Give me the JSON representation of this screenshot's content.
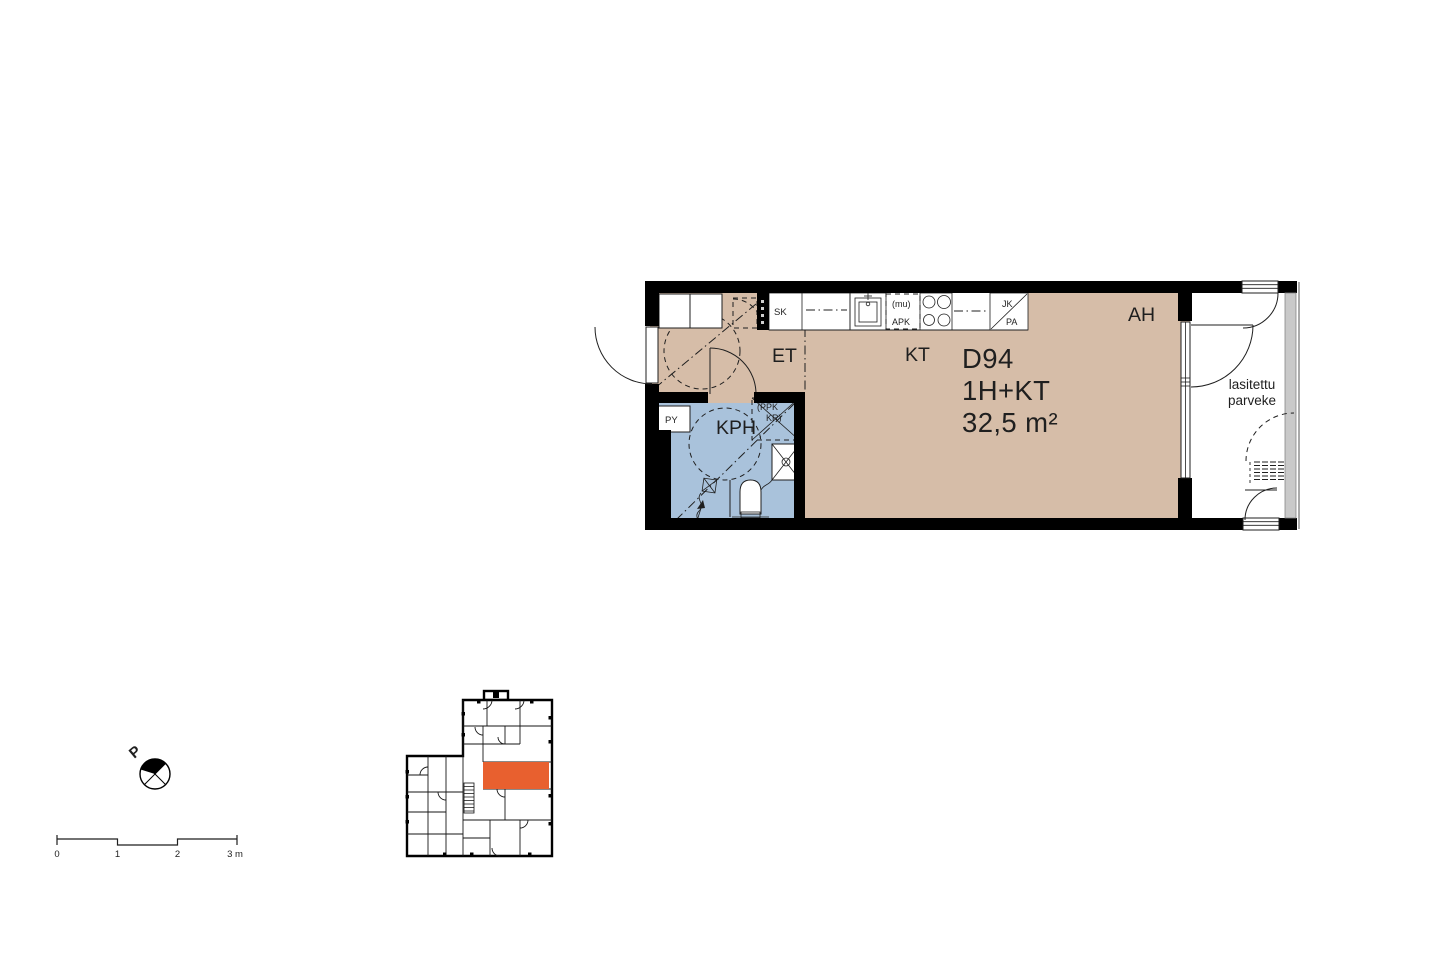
{
  "floor_plan": {
    "unit": {
      "id": "D94",
      "layout": "1H+KT",
      "area": "32,5 m²"
    },
    "rooms": {
      "entrance": "ET",
      "kitchen": "KT",
      "living": "AH",
      "bathroom": "KPH"
    },
    "balcony": {
      "label_line1": "lasitettu",
      "label_line2": "parveke"
    },
    "labels": {
      "closet": "SK",
      "laundry_reservation": "PY",
      "microwave_reservation": "(mu)",
      "dishwasher": "APK",
      "fridge": "JK",
      "freezer": "PA",
      "washer_reservation": "(PPK",
      "dryer_reservation": "KR)"
    },
    "colors": {
      "floor": "#D6BDA8",
      "bathroom_floor": "#A9C2DB",
      "wall": "#000000",
      "glazing": "#C9C9C9"
    }
  },
  "key_plan": {
    "highlight_color": "#E8602F"
  },
  "north_arrow": {
    "label": "P"
  },
  "scale_bar": {
    "ticks": [
      "0",
      "1",
      "2",
      "3 m"
    ]
  }
}
